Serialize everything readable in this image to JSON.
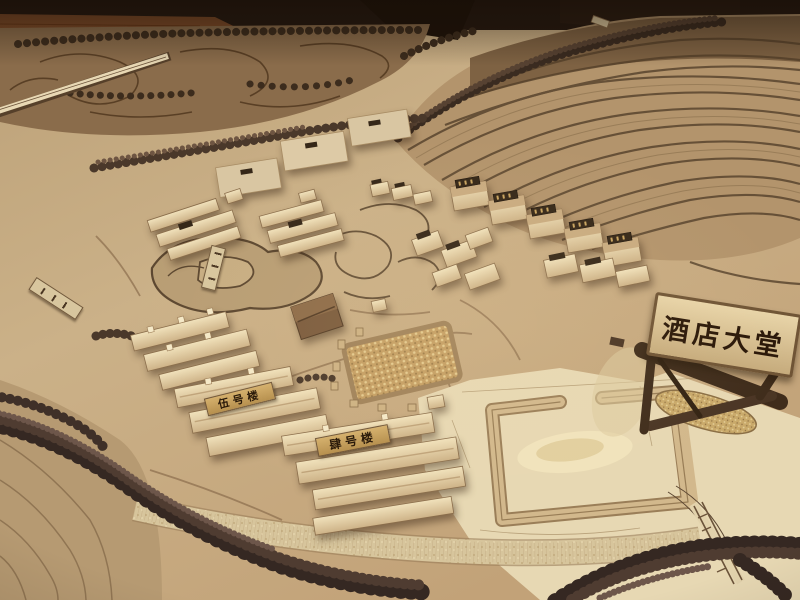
{
  "scene": {
    "kind": "photograph",
    "subject": "wooden architectural scale model of a resort site"
  },
  "signs": {
    "hotel_lobby": "酒店大堂",
    "building_no5": "伍号楼",
    "building_no4": "肆号楼"
  },
  "palette": {
    "base_tan": "#c6ab82",
    "terrain_line": "#564129",
    "terrace_dark": "#54402a",
    "wood_floor": "#7c4a28",
    "background_dark": "#241810",
    "building_light": "#eedcb4",
    "building_shadow": "#8a6d4b",
    "plaque_gold": "#c8a35f",
    "plaque_dark": "#352718",
    "signboard": "#d9c49c",
    "sign_text": "#2a1708",
    "plywood": "#e7d8b3",
    "tree_dark": "#3f3028"
  }
}
